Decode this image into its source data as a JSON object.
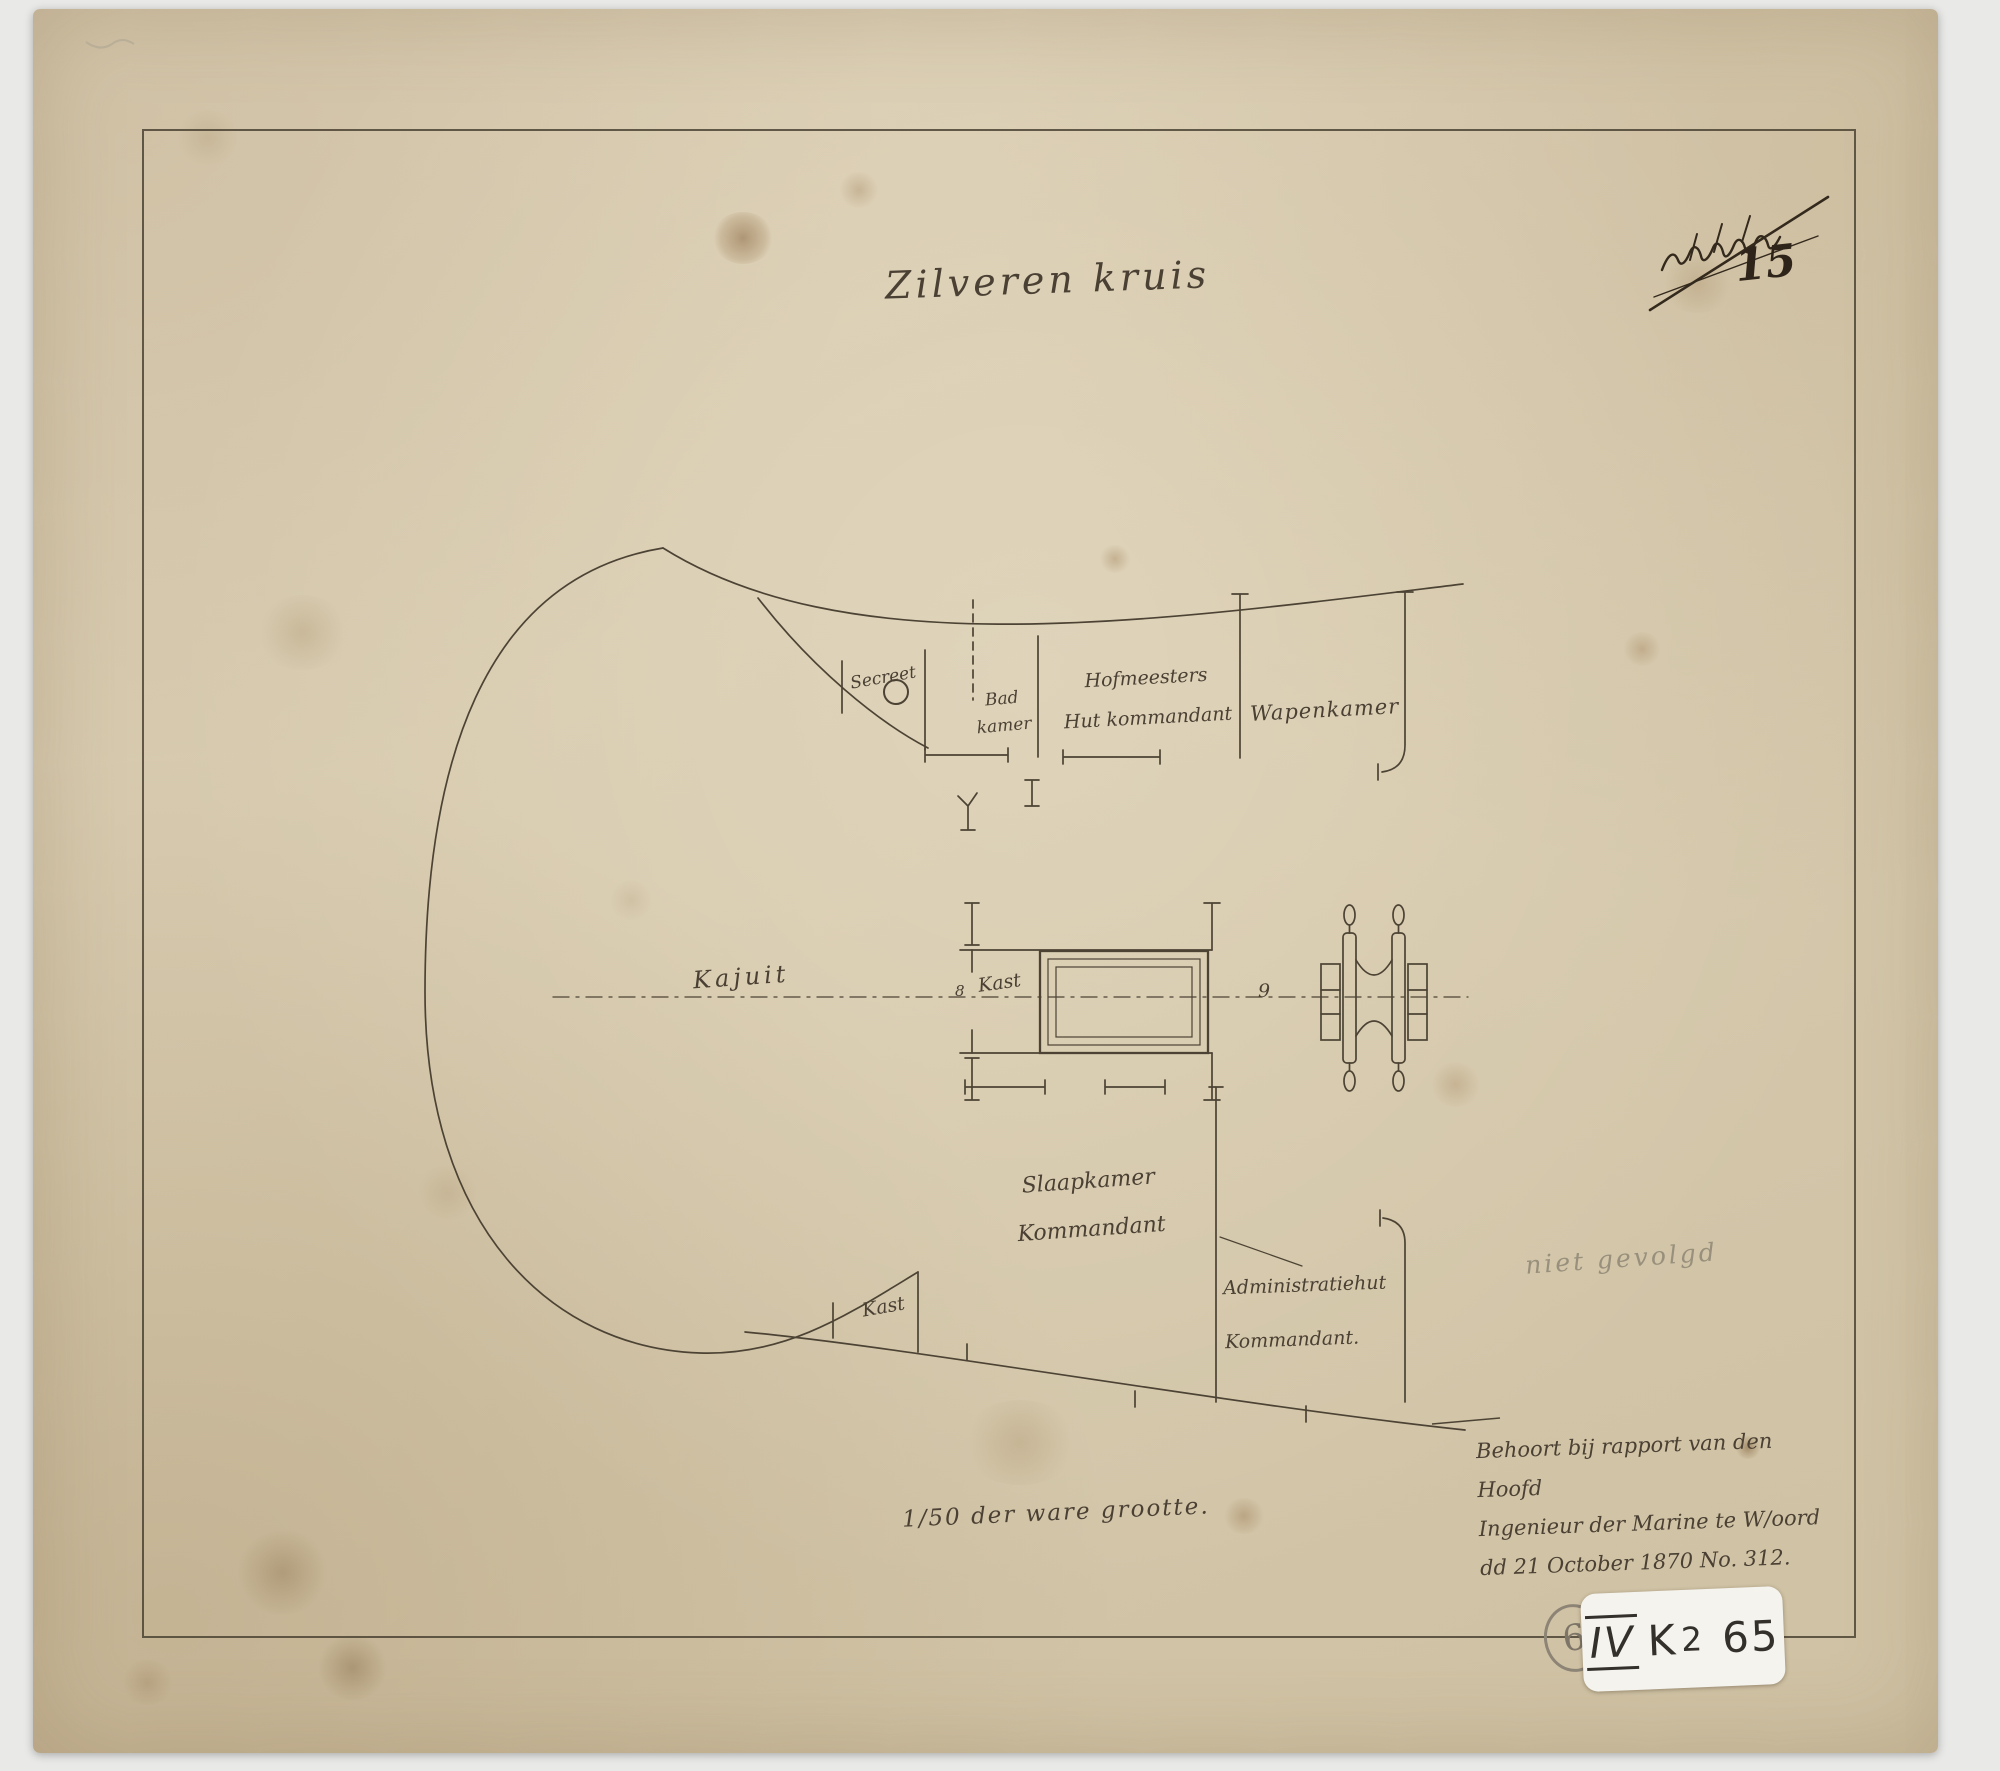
{
  "colors": {
    "paper": "#d6c9ad",
    "background": "#e9e9e7",
    "ink": "#4a4033",
    "ink_dark": "#32291c",
    "pencil": "#98907c",
    "sticker": "#f4f3ee"
  },
  "title": "Zilveren kruis",
  "corner_annotation": {
    "crossed_out_scribble": "illegible (struck through)",
    "number": "15"
  },
  "rooms": {
    "secreet": "Secreet",
    "badkamer": {
      "line1": "Bad",
      "line2": "kamer"
    },
    "hofmeesters": {
      "line1": "Hofmeesters",
      "line2": "Hut kommandant"
    },
    "wapenkamer": "Wapenkamer",
    "kajuit": "Kajuit",
    "kast_middle": "Kast",
    "kast_lower": "Kast",
    "slaapkamer": {
      "line1": "Slaapkamer",
      "line2": "Kommandant"
    },
    "administratiehut": {
      "line1": "Administratiehut",
      "line2": "Kommandant."
    },
    "station_marks": {
      "mark_8": "8",
      "mark_9": "9"
    }
  },
  "annotations": {
    "pencil_note": "niet gevolgd",
    "scale_note": "1/50 der ware grootte.",
    "report_note": {
      "line1": "Behoort bij rapport van den Hoofd",
      "line2": "Ingenieur der Marine te W/oord",
      "line3": "dd 21 October 1870 No. 312."
    }
  },
  "archive_label": {
    "roman": "IV",
    "code": "K",
    "code_number": "2",
    "number": "65",
    "stamp": "6"
  }
}
